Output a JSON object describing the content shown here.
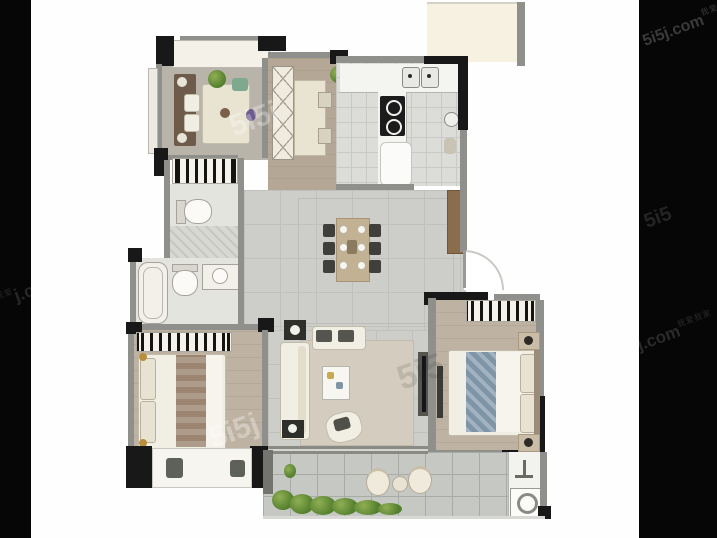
{
  "meta": {
    "type": "floor-plan-photo",
    "description": "Low-resolution real-estate floor-plan photo, letterboxed by black side bars, overlaid with 5i5j (我爱我家) agency watermarks"
  },
  "watermarks": {
    "brand_latin": "5i5j.com",
    "brand_cn": "我爱我家",
    "left_bar_fragment": "j.c",
    "left_bar_cn_fragment": "我爱",
    "right_bar_fragment_mid": "5i5",
    "right_bar_fragment_low": "5j.com",
    "plan_fragment_1": "5i5j",
    "plan_fragment_2": "5i5",
    "plan_fragment_3": "5i5j"
  },
  "colors": {
    "letterbox": "#060606",
    "background": "#fefefe",
    "wall_dark": "#181818",
    "wall_gray": "#8f8f8b",
    "wood_floor": "#b3a795",
    "bedroom_floor": "#bcb1a0",
    "hall_tile": "#cdcdc9",
    "kitchen_tile": "#dcdcd8",
    "balcony_tile": "#c6c8c4",
    "furniture_cream": "#f1eee3",
    "dining_table_tan": "#c2b193",
    "duvet_blue": "#7e95a8",
    "plant_green": "#5d8f3c",
    "shoe_cabinet_brown": "#8a6e4c",
    "utility_platform_cream": "#f6f1e1"
  },
  "rooms": [
    {
      "name": "multifunction-room",
      "position": "top-left",
      "furniture": [
        "table-with-chairs",
        "sideboard-with-lamps",
        "top-bay-window",
        "potted-plant"
      ]
    },
    {
      "name": "foyer-corridor",
      "position": "top-center",
      "furniture": [
        "lattice-cabinet",
        "console-table",
        "two-stools",
        "potted-plant"
      ]
    },
    {
      "name": "kitchen",
      "position": "top-right",
      "furniture": [
        "double-basin-sink",
        "two-burner-cooktop",
        "island-counter",
        "counters"
      ]
    },
    {
      "name": "utility-platform",
      "position": "top-right-outside",
      "furniture": []
    },
    {
      "name": "bathroom-upper",
      "position": "mid-left",
      "furniture": [
        "vanity",
        "toilet",
        "shower-stall"
      ]
    },
    {
      "name": "bathroom-lower",
      "position": "mid-left",
      "furniture": [
        "bathtub",
        "toilet",
        "wash-basin"
      ]
    },
    {
      "name": "dining-hall",
      "position": "center",
      "furniture": [
        "six-seat-dining-table",
        "shoe-cabinet",
        "entry-door-arc"
      ]
    },
    {
      "name": "living-room",
      "position": "bottom-center",
      "furniture": [
        "sofa",
        "bench-seat",
        "coffee-table",
        "lounge-chair",
        "tv-console",
        "floor-lamp-tables",
        "rug"
      ]
    },
    {
      "name": "bedroom-secondary",
      "position": "bottom-left",
      "furniture": [
        "double-bed-with-runner",
        "wardrobe",
        "bay-window-seat",
        "two-stools"
      ]
    },
    {
      "name": "bedroom-master",
      "position": "bottom-right",
      "furniture": [
        "double-bed-blue-duvet",
        "wardrobe",
        "two-nightstands",
        "wall-tv"
      ]
    },
    {
      "name": "balcony",
      "position": "bottom",
      "furniture": [
        "two-round-chairs",
        "round-side-table",
        "planting-strip",
        "laundry-sink",
        "washing-machine"
      ]
    }
  ]
}
